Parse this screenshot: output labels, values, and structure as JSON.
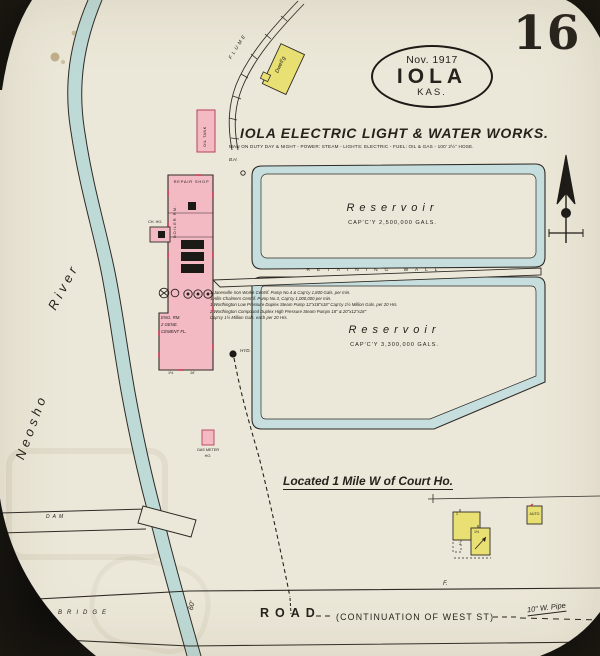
{
  "palette": {
    "paper": "#ece8d9",
    "building_pink": "#f4bac4",
    "building_yellow": "#e9e073",
    "water_blue": "#c6dfde",
    "ink": "#26221c"
  },
  "page": {
    "number": "16",
    "stamp": {
      "date": "Nov. 1917",
      "city": "IOLA",
      "state": "KAS."
    },
    "title": "IOLA ELECTRIC LIGHT & WATER WORKS.",
    "subtitle": "MAN ON DUTY DAY & NIGHT - POWER: STEAM - LIGHTS: ELECTRIC - FUEL: OIL & GAS - 100' 2½\" HOSE.",
    "located_note": "Located 1 Mile W of Court Ho."
  },
  "geo": {
    "river_word1": "Neosho",
    "river_word2": "River",
    "dam": "DAM",
    "bridge": "BRIDGE",
    "flume": "FLUME",
    "road": "ROAD",
    "road_cont": "(CONTINUATION OF WEST ST)",
    "road_pipe": "10\" W. Pipe",
    "road_width": "60'",
    "fence_mark": "F."
  },
  "waterworks": {
    "reservoir_north": {
      "name": "Reservoir",
      "capacity": "CAP'C'Y 2,500,000 GALS."
    },
    "reservoir_south": {
      "name": "Reservoir",
      "capacity": "CAP'C'Y 3,300,000 GALS."
    },
    "retaining_wall": "RETAINING WALL",
    "machinery_notes": [
      "1 Janesville Iron Works Centrif. Pump No.4 & Cap'cy 1,800 Gals. per min.",
      "1 Allis-Chalmers Centrif. Pump No.3, Cap'cy 1,000,000 per min.",
      "1 Worthington Low Pressure Duplex Steam Pump 12\"x18\"x18\" Cap'cy 1½ Million Gals. per 20 Hrs.",
      "2 Worthington Compound Duplex High Pressure Steam Pumps 18\" & 20\"x12\"x18\"",
      "Cap'cy 1½ Million Gals. each per 20 Hrs."
    ],
    "plant": {
      "repair_shop": "REPAIR SHOP",
      "boiler_room": "BOILER RM.",
      "eng_line1": "ENG. RM.",
      "eng_line2": "2 GENE.",
      "eng_line3": "CEMENT FL.",
      "dim_a": "1½",
      "dim_b": "16'"
    },
    "oil_tank": "OIL TANK",
    "chemical_house": "CH. HO.",
    "gas_meter_line1": "GAS METER",
    "gas_meter_line2": "HO.",
    "borehole": "B.H.",
    "hydrant": "HYD."
  },
  "buildings": {
    "dwelling": "Dwell'g",
    "auto": "AUTO",
    "mark1": "1",
    "mark2": "1½",
    "mark3": "2"
  }
}
